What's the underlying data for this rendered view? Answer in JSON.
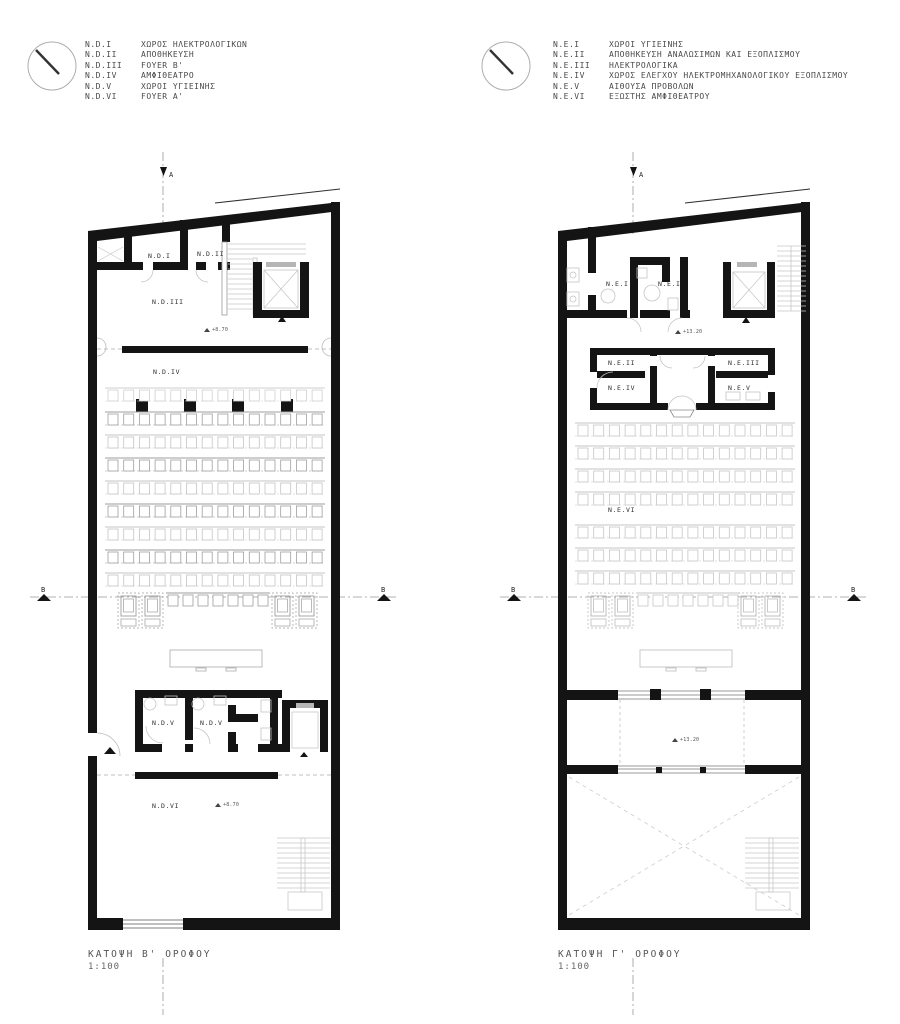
{
  "style": {
    "ink": "#141414",
    "light_line": "#c4c4c4",
    "mid_line": "#9e9e9e",
    "text": "#4a4a4a"
  },
  "legend_left": {
    "items": [
      {
        "code": "N.D.I",
        "name": "ΧΩΡΟΣ ΗΛΕΚΤΡΟΛΟΓΙΚΩΝ"
      },
      {
        "code": "N.D.II",
        "name": "ΑΠΟΘΗΚΕΥΣΗ"
      },
      {
        "code": "N.D.III",
        "name": "FOYER B'"
      },
      {
        "code": "N.D.IV",
        "name": "ΑΜΦΙΘΕΑΤΡΟ"
      },
      {
        "code": "N.D.V",
        "name": "ΧΩΡΟΙ ΥΓΙΕΙΝΗΣ"
      },
      {
        "code": "N.D.VI",
        "name": "FOYER A'"
      }
    ]
  },
  "legend_right": {
    "items": [
      {
        "code": "N.E.I",
        "name": "ΧΩΡΟΙ ΥΓΙΕΙΝΗΣ"
      },
      {
        "code": "N.E.II",
        "name": "ΑΠΟΘΗΚΕΥΣΗ ΑΝΑΛΩΣΙΜΩΝ ΚΑΙ ΕΞΟΠΛΙΣΜΟΥ"
      },
      {
        "code": "N.E.III",
        "name": "ΗΛΕΚΤΡΟΛΟΓΙΚΑ"
      },
      {
        "code": "N.E.IV",
        "name": "ΧΩΡΟΣ ΕΛΕΓΧΟΥ ΗΛΕΚΤΡΟΜΗΧΑΝΟΛΟΓΙΚΟΥ ΕΞΟΠΛΙΣΜΟΥ"
      },
      {
        "code": "N.E.V",
        "name": "ΑΙΘΟΥΣΑ ΠΡΟΒΟΛΩΝ"
      },
      {
        "code": "N.E.VI",
        "name": "ΕΞΩΣΤΗΣ ΑΜΦΙΘΕΑΤΡΟΥ"
      }
    ]
  },
  "plans": {
    "left": {
      "caption": "ΚΑΤΟΨΗ Β' ΟΡΟΦΟΥ",
      "scale": "1:100",
      "rooms": {
        "ndi": "N.D.I",
        "ndii": "N.D.II",
        "ndiii": "N.D.III",
        "ndiv": "N.D.IV",
        "ndv": "N.D.V",
        "ndvi": "N.D.VI"
      },
      "level": "+8.70"
    },
    "right": {
      "caption": "ΚΑΤΟΨΗ Γ' ΟΡΟΦΟΥ",
      "scale": "1:100",
      "rooms": {
        "nei": "N.E.I",
        "neii": "N.E.II",
        "neiii": "N.E.III",
        "neiv": "N.E.IV",
        "nev": "N.E.V",
        "nevi": "N.E.VI"
      },
      "level": "+13.20"
    },
    "sections": {
      "a": "A",
      "b": "B"
    }
  }
}
